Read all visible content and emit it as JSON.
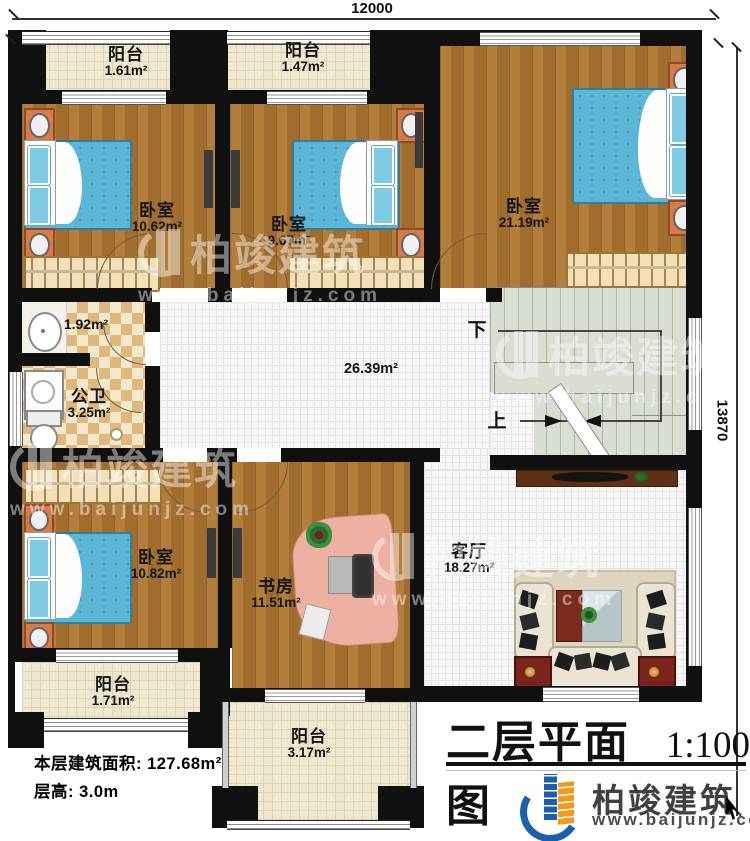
{
  "plan": {
    "dimension_top": "12000",
    "dimension_right": "13870",
    "title": "二层平面图",
    "scale": "1:100",
    "info_area": "本层建筑面积: 127.68m²",
    "info_height": "层高: 3.0m"
  },
  "rooms": {
    "balcony_top_left": {
      "name": "阳台",
      "area": "1.61m²"
    },
    "balcony_top_mid": {
      "name": "阳台",
      "area": "1.47m²"
    },
    "bedroom_top_left": {
      "name": "卧室",
      "area": "10.62m²"
    },
    "bedroom_top_mid": {
      "name": "卧室",
      "area": "9.67m²"
    },
    "bedroom_top_right": {
      "name": "卧室",
      "area": "21.19m²"
    },
    "washroom": {
      "area": "1.92m²"
    },
    "bathroom": {
      "name": "公卫",
      "area": "3.25m²"
    },
    "hallway": {
      "area": "26.39m²"
    },
    "bedroom_bottom_left": {
      "name": "卧室",
      "area": "10.82m²"
    },
    "study": {
      "name": "书房",
      "area": "11.51m²"
    },
    "living_room": {
      "name": "客厅",
      "area": "18.27m²"
    },
    "balcony_bottom_left": {
      "name": "阳台",
      "area": "1.71m²"
    },
    "balcony_bottom_mid": {
      "name": "阳台",
      "area": "3.17m²"
    }
  },
  "stairs": {
    "down_label": "下",
    "up_label": "上"
  },
  "brand": {
    "name": "柏竣建筑",
    "url": "www.baijunjz.com"
  },
  "watermark": {
    "name": "柏竣建筑",
    "url": "www.baijunjz.com"
  },
  "colors": {
    "wall": "#101010",
    "wood_floor": "#ab7534",
    "bed_blue": "#5cb6d6",
    "logo_blue": "#1b5fae",
    "logo_orange": "#f49a1b"
  }
}
